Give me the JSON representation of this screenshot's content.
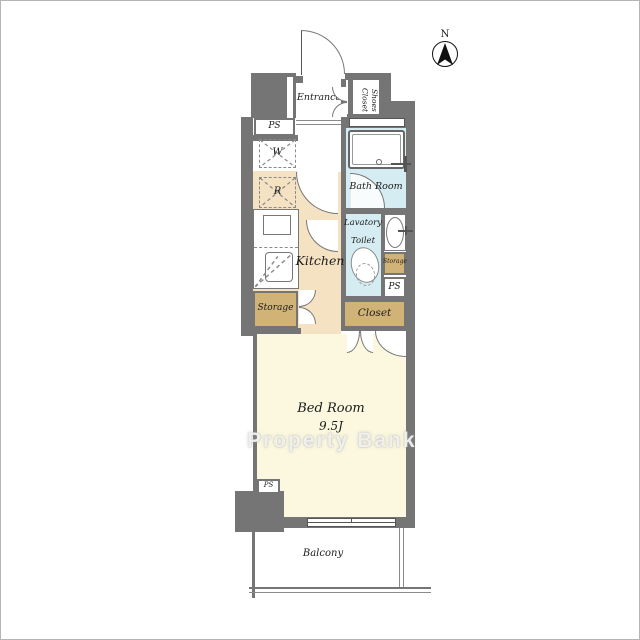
{
  "compass": {
    "north_label": "N"
  },
  "labels": {
    "entrance": "Entrance",
    "shoes_closet_line1": "Shoes",
    "shoes_closet_line2": "Closet",
    "ps_entrance": "PS",
    "washer": "W",
    "refrigerator": "R",
    "bath_room": "Bath Room",
    "lavatory_line1": "Lavatory",
    "lavatory_line2": "Toilet",
    "kitchen": "Kitchen",
    "storage_kitchen": "Storage",
    "storage_lavatory": "Storage",
    "ps_lavatory": "PS",
    "closet": "Closet",
    "bedroom_name": "Bed Room",
    "bedroom_size": "9.5J",
    "ps_bedroom": "PS",
    "balcony": "Balcony"
  },
  "watermark": {
    "text": "Property Bank"
  },
  "colors": {
    "wall": "#757575",
    "kitchen_floor": "#f5e2c3",
    "wet_area_floor": "#d5ecf2",
    "storage_fill": "#d2b377",
    "bedroom_floor": "#fbf8df"
  }
}
